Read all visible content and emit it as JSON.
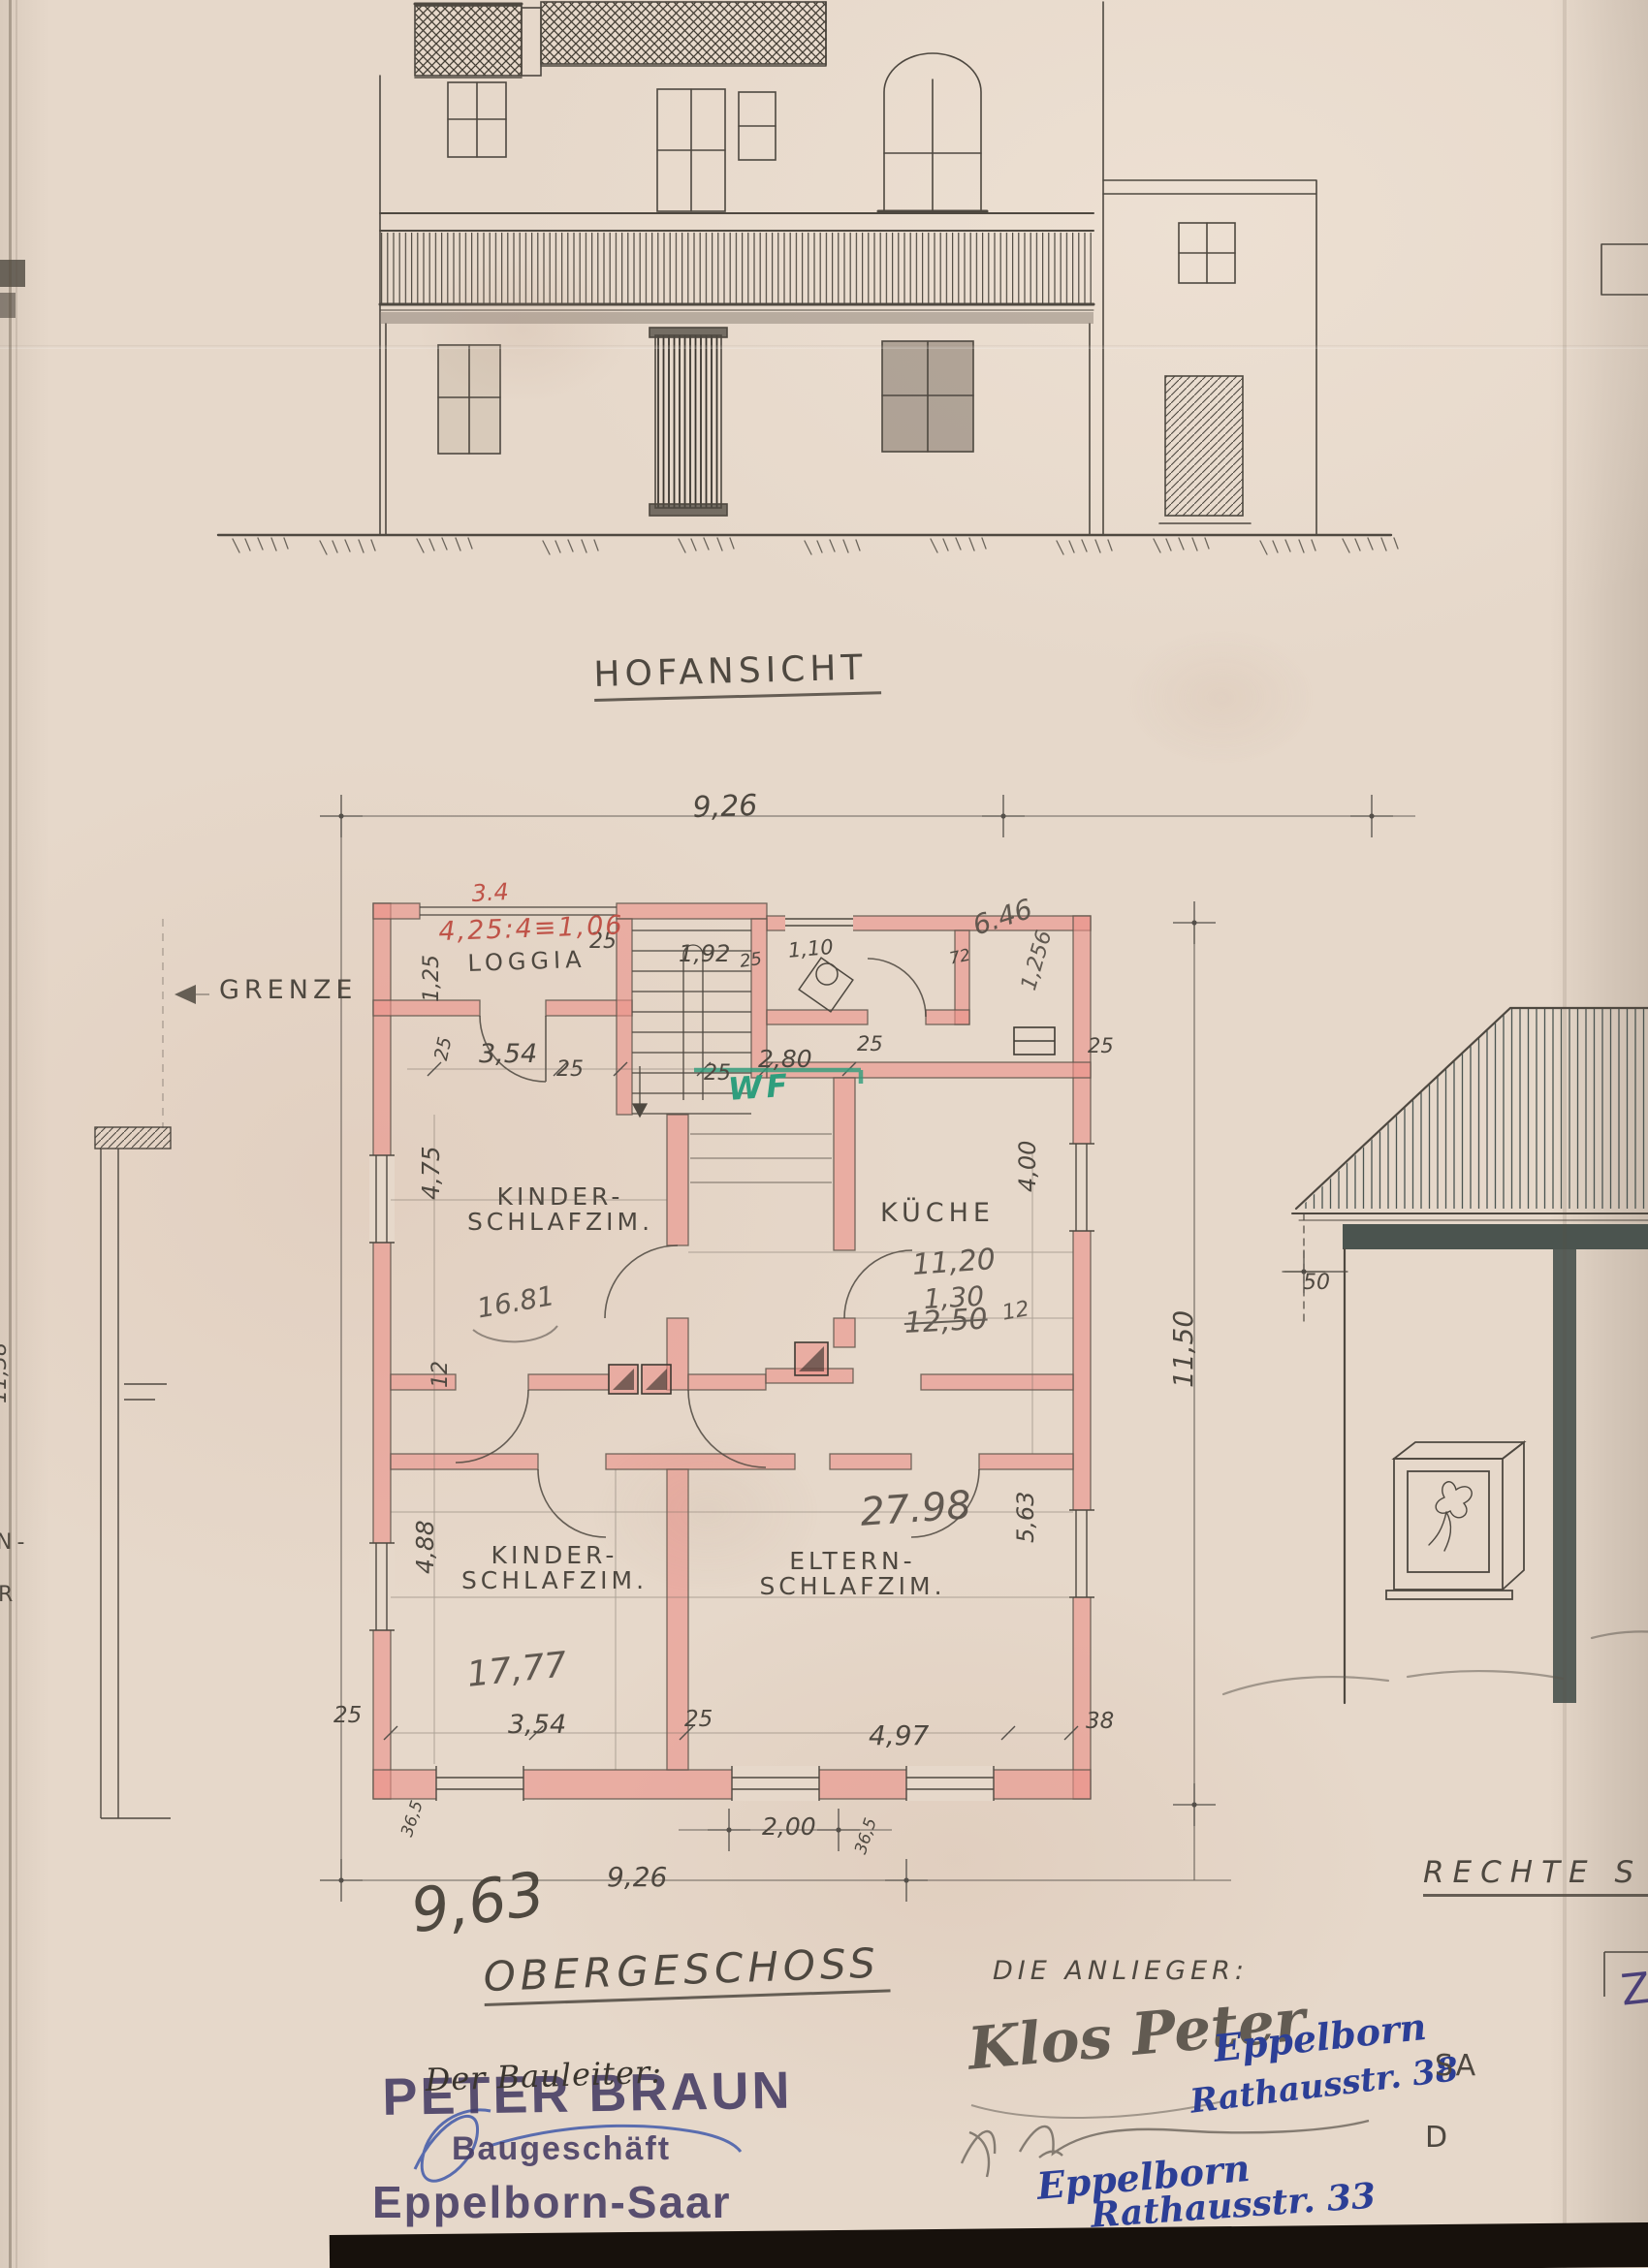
{
  "colors": {
    "paper": "#e6d8ca",
    "ink": "#4e4840",
    "pencil": "#564f47",
    "wall_pink": "#eb9189",
    "red_pencil": "#bf5348",
    "green_marker": "#2f9e7d",
    "blue_ink": "#2c3f96",
    "stamp_purple": "#453b63"
  },
  "titles": {
    "elevation": "HOFANSICHT",
    "floor": "OBERGESCHOSS",
    "side_view_partial": "RECHTE S",
    "anlieger_heading": "DIE ANLIEGER:",
    "boundary": "GRENZE"
  },
  "rooms": {
    "loggia": "LOGGIA",
    "kitchen": "KÜCHE",
    "child1_line1": "KINDER-",
    "child1_line2": "SCHLAFZIM.",
    "child2_line1": "KINDER-",
    "child2_line2": "SCHLAFZIM.",
    "parents_line1": "ELTERN-",
    "parents_line2": "SCHLAFZIM."
  },
  "dims": {
    "width_top": "9,26",
    "width_bottom": "9,26",
    "d354_top": "3,54",
    "d354_bottom": "3,54",
    "d475": "4,75",
    "d488": "4,88",
    "d497": "4,97",
    "d125": "1,25",
    "d192": "1,92",
    "d110": "1,10",
    "d280": "2,80",
    "d400": "4,00",
    "d1150": "11,50",
    "d563": "5,63",
    "d200": "2,00",
    "d25": "25",
    "d365": "36,5",
    "d72": "72",
    "d12": "12",
    "d38": "38",
    "d50": "50",
    "d1138": "11,38"
  },
  "pencil_notes": {
    "p34": "3.4",
    "formula": "4,25:4≡1,06",
    "p646": "6.46",
    "p1256": "1,256",
    "p1120": "11,20",
    "p130": "1,30",
    "p1250": "12,50",
    "p12": "12",
    "p1681": "16.81",
    "p2798": "27.98",
    "p1777": "17,77",
    "p963": "9,63"
  },
  "green_note": "WF",
  "stamp": {
    "name": "PETER BRAUN",
    "line2": "Baugeschäft",
    "city": "Eppelborn-Saar"
  },
  "handwriting": {
    "bauleiter": "Der Bauleiter:",
    "signature1": "Klos Peter",
    "addr1_line1": "Eppelborn",
    "addr1_line2": "Rathausstr. 38",
    "addr2_line1": "Eppelborn",
    "addr2_line2": "Rathausstr. 33"
  },
  "fragments": {
    "right_edge_top": "SA",
    "right_edge_mid": "D",
    "title_box": "Z",
    "left_edge_a": "N-",
    "left_edge_b": "R"
  }
}
